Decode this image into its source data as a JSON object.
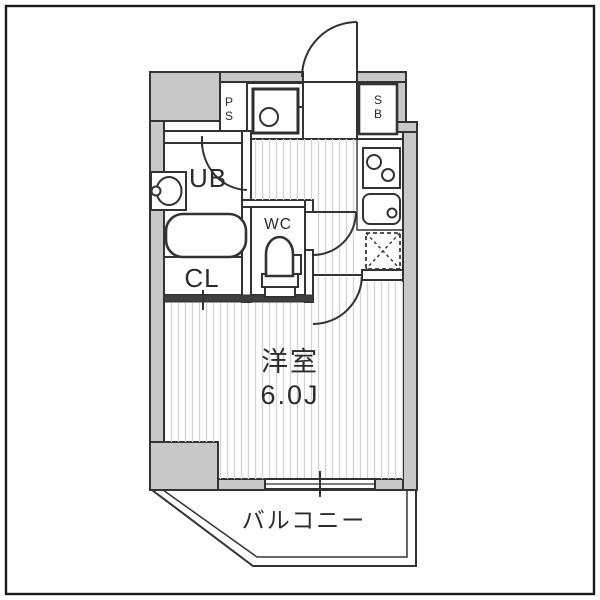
{
  "labels": {
    "pipe_space": [
      "P",
      "S"
    ],
    "shoe_box": [
      "S",
      "B"
    ],
    "unit_bath": "UB",
    "toilet_room": "WC",
    "closet": "CL",
    "main_room_name": "洋室",
    "main_room_size": "6.0J",
    "balcony": "バルコニー"
  },
  "colors": {
    "wall_fill": "#c8c8c8",
    "line": "#333333",
    "hatch_stripe": "#d4d4d4",
    "text": "#2b2b2b",
    "background": "#ffffff"
  }
}
